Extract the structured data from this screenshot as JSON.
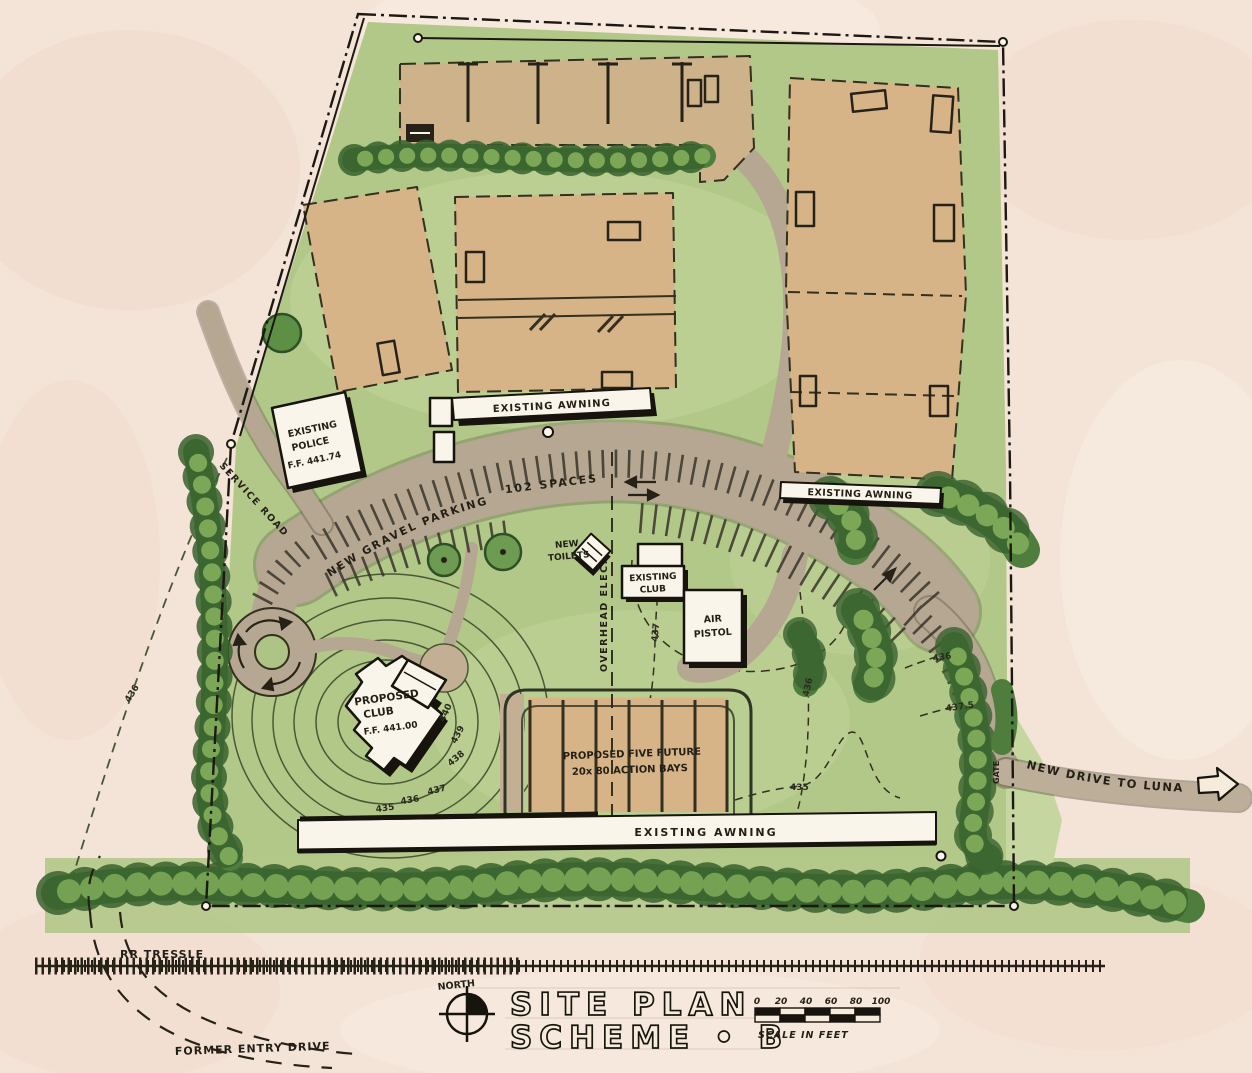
{
  "drawing": {
    "type": "hand-drawn architectural site plan, watercolor rendering",
    "sheet": "SITE PLAN SCHEME B"
  },
  "title_block": {
    "north_label": "NORTH",
    "title_line1": "SITE PLAN",
    "title_line2": "SCHEME • B",
    "scale_ticks": [
      "0",
      "20",
      "40",
      "60",
      "80",
      "100"
    ],
    "scale_caption": "SCALE IN FEET"
  },
  "labels": {
    "police_1": "EXISTING",
    "police_2": "POLICE",
    "police_3": "F.F. 441.74",
    "awning_top": "EXISTING AWNING",
    "awning_right": "EXISTING AWNING",
    "awning_bottom": "EXISTING AWNING",
    "service_road": "SERVICE ROAD",
    "gravel_parking": "NEW GRAVEL PARKING",
    "spaces": "102 SPACES",
    "toilets_1": "NEW",
    "toilets_2": "TOILETS",
    "club_1": "EXISTING",
    "club_2": "CLUB",
    "pistol_1": "AIR",
    "pistol_2": "PISTOL",
    "prop_1": "PROPOSED",
    "prop_2": "CLUB",
    "prop_3": "F.F. 441.00",
    "elec": "OVERHEAD ELEC.",
    "bays_1": "PROPOSED FIVE FUTURE",
    "bays_2": "20x 80 ACTION BAYS",
    "drive": "NEW DRIVE TO LUNA RD.",
    "gate": "GATE",
    "rr": "RR TRESSLE",
    "former": "FORMER ENTRY DRIVE"
  },
  "contours": {
    "c440": "440",
    "c439": "439",
    "c438": "438",
    "c437": "437",
    "c436": "436",
    "c435": "435",
    "c437v": "437",
    "c436m": "436",
    "c435b": "435",
    "c436r": "436",
    "c4375r": "437.5",
    "c436l": "436"
  },
  "colors": {
    "paper": "#f4e3d7",
    "paper_wash_pink": "#ecd0bf",
    "lawn": "#b2c889",
    "lawn_light": "#c6d6a0",
    "tree_dark": "#38612e",
    "tree_mid": "#4e7d3d",
    "tree_light": "#7ca757",
    "range_tan": "#d6b488",
    "gravel": "#b5a791",
    "ink": "#262217",
    "building_white": "#faf5ea",
    "contour_olive": "#4a5835"
  }
}
